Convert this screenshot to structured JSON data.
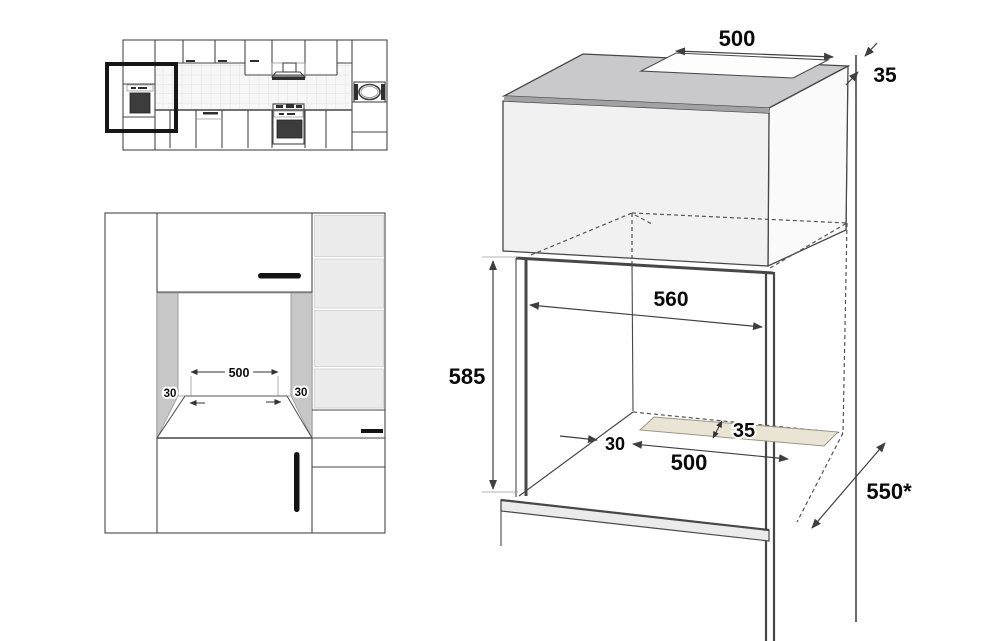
{
  "front_view": {
    "labels": {
      "opening_width": "500",
      "left_clearance": "30",
      "right_clearance": "30"
    }
  },
  "perspective": {
    "labels": {
      "top_cutout_width": "500",
      "rear_wall_gap": "35",
      "niche_width": "560",
      "niche_height": "585",
      "vent_front_offset": "30",
      "vent_width": "500",
      "vent_depth": "35",
      "niche_depth": "550*"
    }
  },
  "colors": {
    "background": "#ffffff",
    "line": "#474747",
    "dash": "#555555",
    "label": "#0a0a0a",
    "top_face": "#c9c9cb",
    "front_face": "#f1f1f2",
    "side_face": "#fafafa",
    "edge_band": "#a2a2a4",
    "niche_side_panel": "#c7c7c7",
    "shelf_panel": "#ececec",
    "tile": "#f7f7f7",
    "tile_line": "#e2e2e2",
    "vent_strip": "#e9e4d4",
    "vent_strip_edge": "#9b9786",
    "highlight_box": "#161616",
    "handle": "#141414"
  }
}
